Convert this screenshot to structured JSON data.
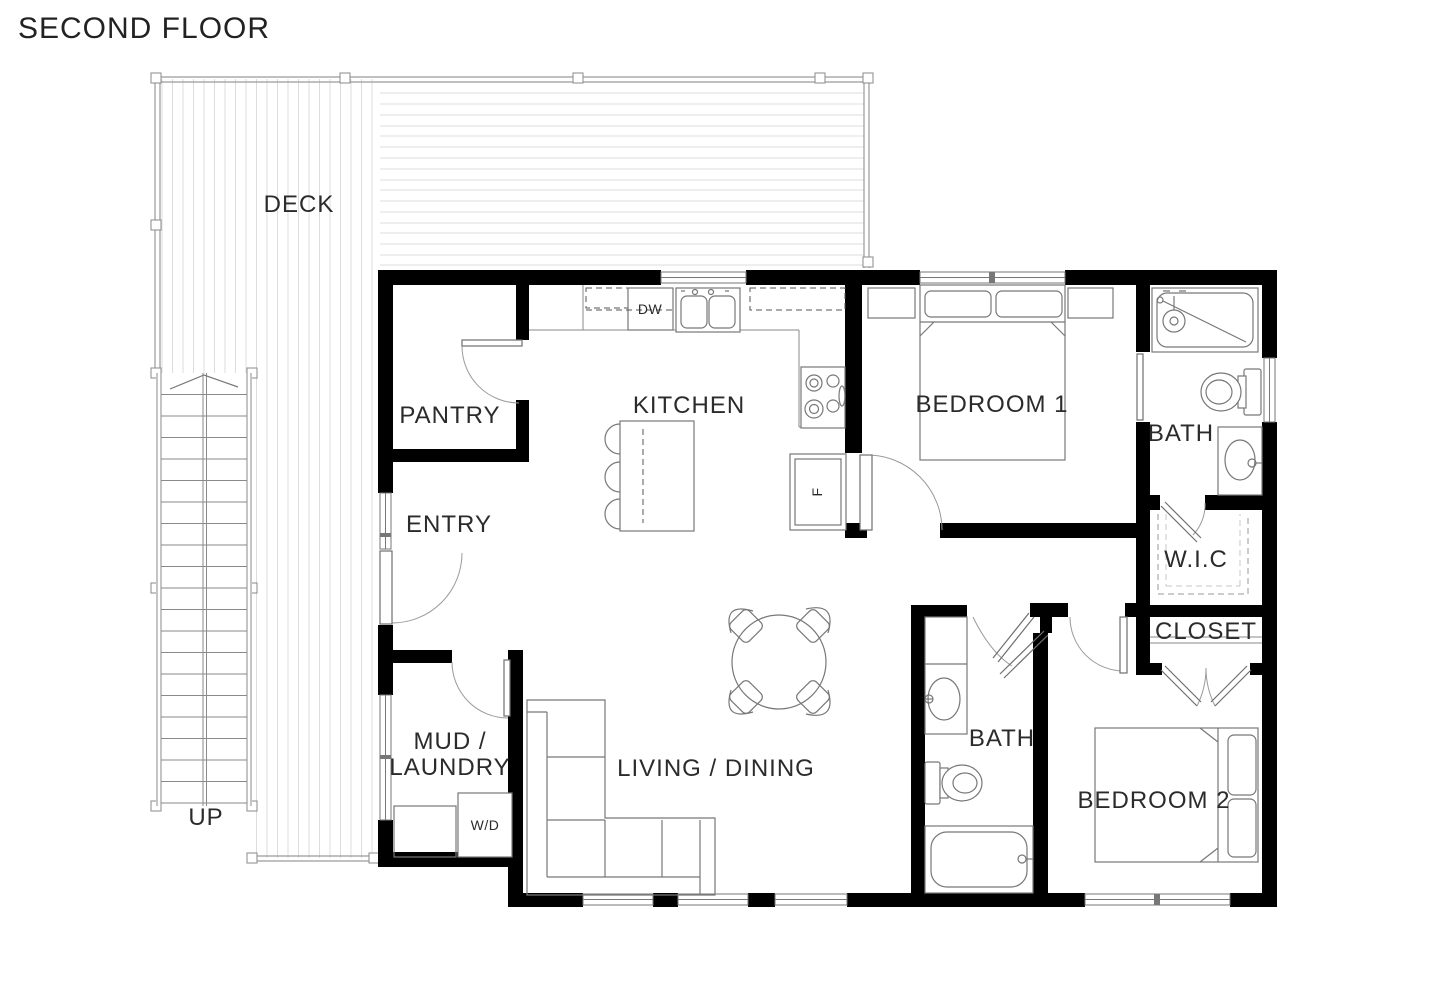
{
  "page": {
    "title": "SECOND FLOOR"
  },
  "plan": {
    "rooms": {
      "deck": "DECK",
      "pantry": "PANTRY",
      "kitchen": "KITCHEN",
      "entry": "ENTRY",
      "bedroom1": "BEDROOM 1",
      "bath1": "BATH",
      "wic": "W.I.C",
      "closet": "CLOSET",
      "mud_line1": "MUD /",
      "mud_line2": "LAUNDRY",
      "living_dining": "LIVING / DINING",
      "bath2": "BATH",
      "bedroom2": "BEDROOM 2"
    },
    "annotations": {
      "stairs_up": "UP",
      "dishwasher": "DW",
      "washer_dryer": "W/D",
      "fridge": "F"
    },
    "colors": {
      "wall": "#000000",
      "fixture_line": "#777777",
      "deck_line": "#dcdcdc",
      "cabinet_fill": "#e4e4e4",
      "label_text": "#2b2b2b"
    }
  }
}
